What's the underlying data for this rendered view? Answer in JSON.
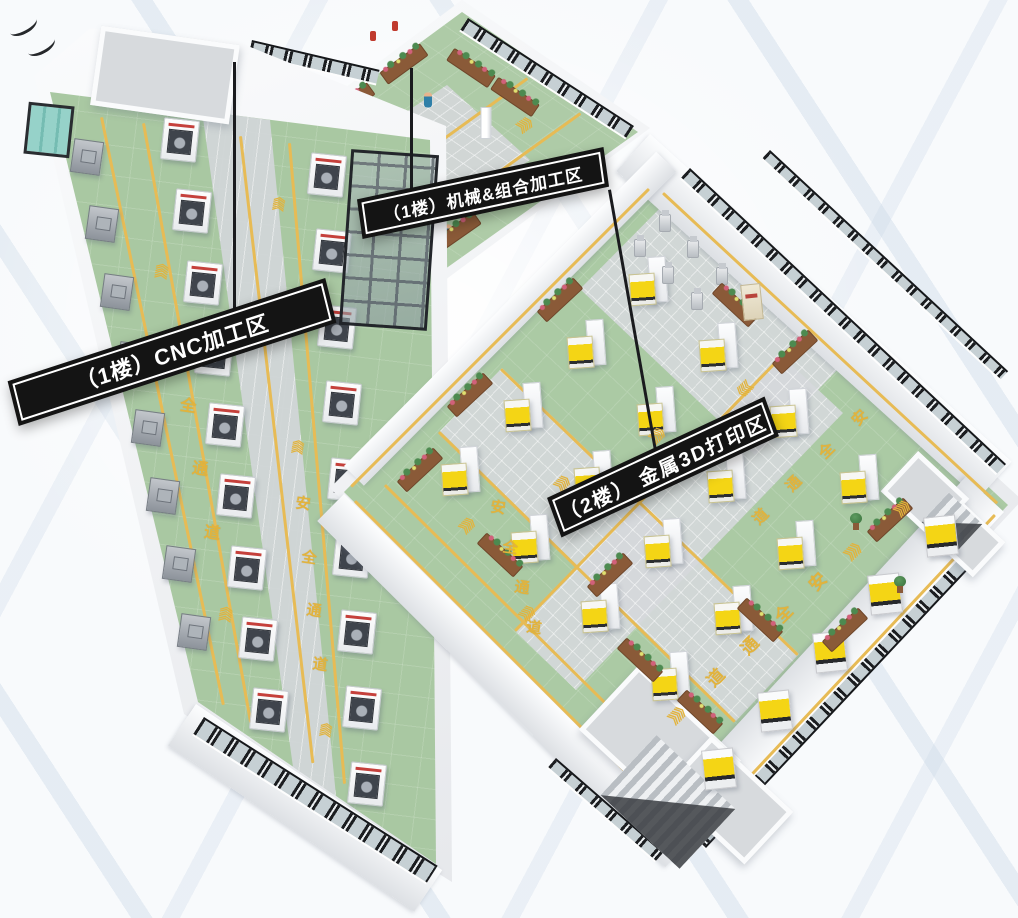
{
  "scene": {
    "background_color": "#f7f9fb",
    "streak_color": "#cfdce8",
    "floor_green": "#a9c8a2",
    "tile_gray": "#d4d7da",
    "lane_yellow": "#e7bb55",
    "floor_text_color": "#e2b33c",
    "banner_bg": "#141414",
    "banner_text_color": "#ffffff",
    "accent_yellow": "#f4d515",
    "accent_red": "#c5403b"
  },
  "zones": [
    {
      "id": "cnc",
      "floor": "1楼",
      "label": "（1楼）CNC加工区",
      "safety_lane_text": "安全通道",
      "chevrons": "《《《",
      "equipment": [
        {
          "name": "cnc-machine",
          "count": 18
        },
        {
          "name": "wall-machine",
          "count": 8
        }
      ]
    },
    {
      "id": "machining",
      "floor": "1楼",
      "label": "（1楼）机械&组合加工区",
      "safety_lane_text": "安全通道",
      "chevrons": "《《《",
      "equipment": [
        {
          "name": "workbench",
          "count": 4
        },
        {
          "name": "machining-center",
          "count": 2
        },
        {
          "name": "industrial-robot",
          "count": 2
        },
        {
          "name": "worker",
          "count": 3
        },
        {
          "name": "flower-planter",
          "count": 8
        }
      ]
    },
    {
      "id": "printing",
      "floor": "2楼",
      "label": "（2楼） 金属3D打印区",
      "safety_lane_text": "安全通道",
      "chevrons": "《《《",
      "equipment": [
        {
          "name": "metal-3d-printer",
          "count": 16
        },
        {
          "name": "wall-printer",
          "count": 5
        },
        {
          "name": "robot-arm",
          "count": 6
        },
        {
          "name": "flower-planter",
          "count": 12
        }
      ]
    }
  ]
}
